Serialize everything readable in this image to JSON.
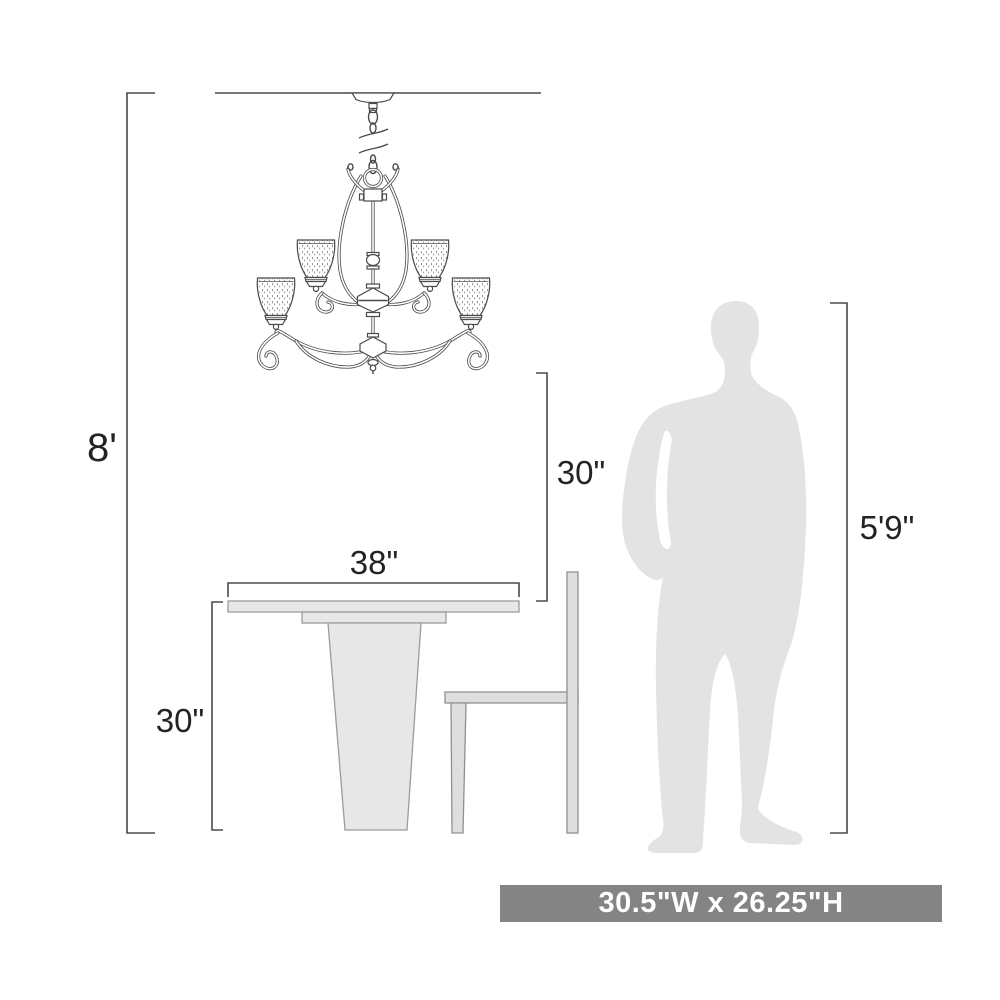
{
  "labels": {
    "ceiling_height": "8'",
    "chandelier_drop": "30\"",
    "table_width": "38\"",
    "table_height": "30\"",
    "person_height": "5'9\""
  },
  "banner": {
    "text": "30.5\"W x 26.25\"H"
  },
  "colors": {
    "dimension_line": "#4a4a4a",
    "drawing_line": "#4a4a4a",
    "furniture_fill": "#e7e7e7",
    "person_fill": "#e3e3e3",
    "banner_bg": "#848484",
    "banner_text": "#ffffff"
  }
}
